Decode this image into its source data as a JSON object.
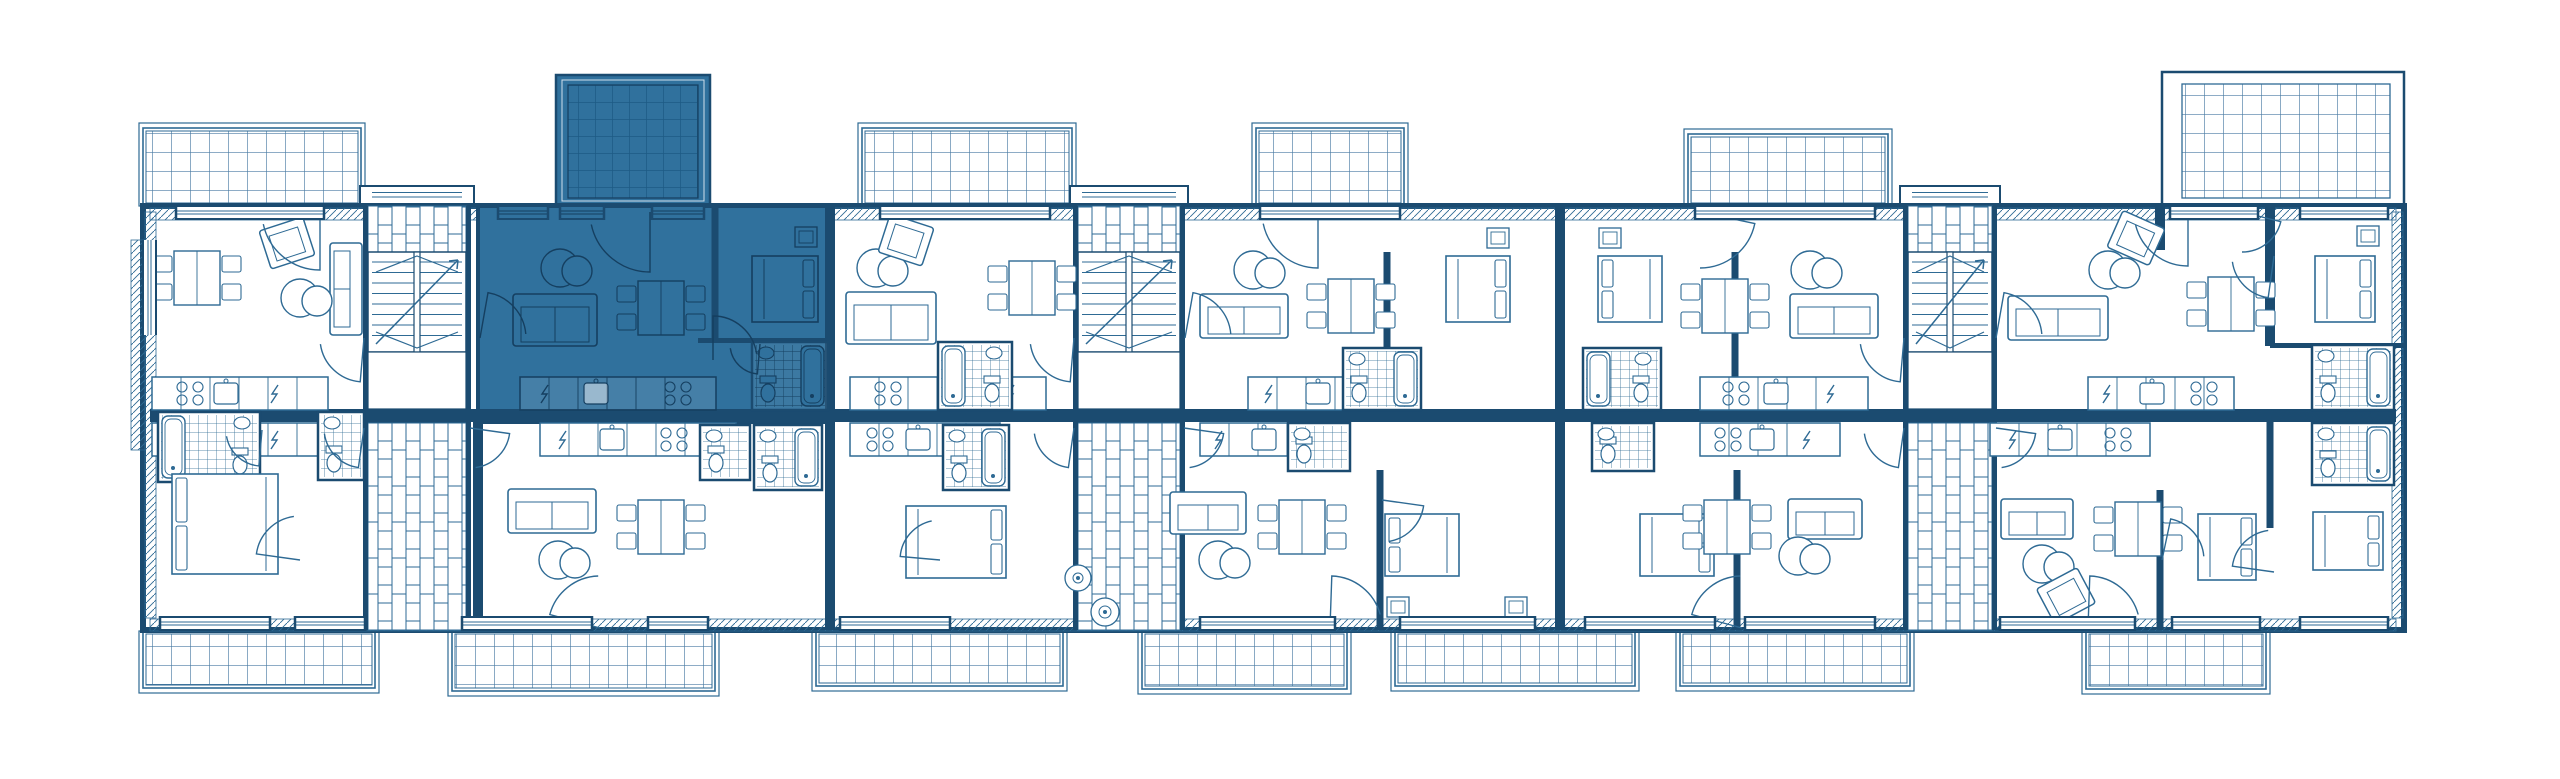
{
  "plan": {
    "canvas": {
      "w": 2560,
      "h": 779
    },
    "colors": {
      "line": "#2e6a94",
      "dark": "#1b4b70",
      "grid": "#4a7ba3",
      "light": "#9db9ce",
      "highlight": "#30719d",
      "highlight_line": "#153f60",
      "highlight_grid": "#1d5a85",
      "background": "#ffffff"
    },
    "building": {
      "x": 143,
      "y": 206,
      "w": 2261,
      "h": 424
    },
    "spine": {
      "x": 150,
      "y": 409,
      "w": 2246,
      "h": 13
    },
    "hatch_bands": [
      [
        150,
        208,
        2246,
        12
      ],
      [
        150,
        619,
        2246,
        12
      ],
      [
        145,
        212,
        11,
        406
      ],
      [
        2392,
        212,
        11,
        406
      ],
      [
        131,
        240,
        14,
        210
      ]
    ],
    "highlight_unit": {
      "x": 478,
      "y": 206,
      "w": 352,
      "h": 216
    },
    "terrace_highlight": [
      556,
      75,
      154,
      131
    ],
    "terrace_right": [
      2162,
      72,
      242,
      134
    ],
    "balconies_top": [
      [
        143,
        128,
        218,
        78
      ],
      [
        862,
        128,
        210,
        78
      ],
      [
        1256,
        128,
        148,
        78
      ],
      [
        1688,
        134,
        200,
        72
      ]
    ],
    "balconies_bottom": [
      [
        143,
        631,
        232,
        57
      ],
      [
        452,
        631,
        263,
        60
      ],
      [
        816,
        631,
        247,
        55
      ],
      [
        1142,
        631,
        205,
        58
      ],
      [
        1395,
        631,
        240,
        55
      ],
      [
        1680,
        631,
        230,
        55
      ],
      [
        2086,
        631,
        180,
        58
      ]
    ],
    "cores": [
      [
        368,
        98
      ],
      [
        1078,
        102
      ],
      [
        1908,
        84
      ]
    ],
    "core_bands": {
      "brick_top_h": 46,
      "stairs_h": 100,
      "landing_h": 57
    },
    "dividers": [
      [
        830,
        206,
        204,
        10
      ],
      [
        1560,
        206,
        204,
        10
      ],
      [
        2270,
        206,
        140,
        10
      ],
      [
        715,
        206,
        136,
        7
      ],
      [
        1387,
        252,
        158,
        7
      ],
      [
        1735,
        252,
        158,
        7
      ],
      [
        2160,
        206,
        44,
        10
      ],
      [
        478,
        422,
        208,
        10
      ],
      [
        830,
        422,
        208,
        10
      ],
      [
        1560,
        422,
        208,
        10
      ],
      [
        1380,
        470,
        160,
        7
      ],
      [
        1737,
        470,
        160,
        7
      ],
      [
        2270,
        422,
        106,
        7
      ],
      [
        2160,
        490,
        140,
        7
      ]
    ],
    "hwalls": [
      [
        698,
        338,
        132
      ],
      [
        2270,
        343,
        134
      ]
    ],
    "windows_top": [
      [
        176,
        148
      ],
      [
        498,
        50
      ],
      [
        560,
        44
      ],
      [
        652,
        52
      ],
      [
        880,
        170
      ],
      [
        1260,
        140
      ],
      [
        1695,
        180
      ],
      [
        2170,
        88
      ],
      [
        2300,
        88
      ]
    ],
    "windows_bottom": [
      [
        160,
        110
      ],
      [
        295,
        70
      ],
      [
        462,
        130
      ],
      [
        648,
        60
      ],
      [
        840,
        110
      ],
      [
        1200,
        135
      ],
      [
        1400,
        135
      ],
      [
        1585,
        130
      ],
      [
        1745,
        130
      ],
      [
        2000,
        135
      ],
      [
        2172,
        88
      ],
      [
        2300,
        88
      ]
    ],
    "windows_left": [
      [
        240,
        95
      ]
    ],
    "kitchens": [
      [
        152,
        377,
        176,
        112,
        62,
        22
      ],
      [
        520,
        377,
        196,
        14,
        64,
        142
      ],
      [
        850,
        377,
        196,
        150,
        96,
        22
      ],
      [
        1248,
        377,
        170,
        10,
        58,
        112
      ],
      [
        1700,
        377,
        168,
        120,
        64,
        20
      ],
      [
        2088,
        377,
        146,
        8,
        52,
        100
      ],
      [
        152,
        423,
        176,
        112,
        62,
        22
      ],
      [
        540,
        423,
        196,
        12,
        60,
        118
      ],
      [
        850,
        423,
        150,
        104,
        56,
        14
      ],
      [
        1200,
        423,
        148,
        8,
        52,
        100
      ],
      [
        1700,
        423,
        140,
        96,
        50,
        12
      ],
      [
        1990,
        423,
        160,
        12,
        58,
        112
      ]
    ],
    "bathrooms": [
      [
        752,
        342,
        76,
        68,
        2
      ],
      [
        938,
        342,
        74,
        68,
        1
      ],
      [
        1343,
        348,
        78,
        62,
        2
      ],
      [
        1583,
        348,
        78,
        62,
        1
      ],
      [
        2312,
        345,
        82,
        65,
        2
      ],
      [
        158,
        412,
        102,
        70,
        1
      ],
      [
        318,
        412,
        46,
        68,
        0
      ],
      [
        700,
        425,
        50,
        55,
        0
      ],
      [
        754,
        425,
        68,
        65,
        2
      ],
      [
        943,
        425,
        66,
        65,
        2
      ],
      [
        1288,
        423,
        62,
        48,
        0
      ],
      [
        1592,
        423,
        62,
        48,
        0
      ],
      [
        2312,
        423,
        82,
        62,
        2
      ]
    ],
    "beds": [
      [
        752,
        256,
        66,
        66,
        "r"
      ],
      [
        1446,
        256,
        64,
        66,
        "r"
      ],
      [
        1598,
        256,
        64,
        66,
        "l"
      ],
      [
        2315,
        256,
        60,
        66,
        "r"
      ],
      [
        172,
        474,
        106,
        100,
        "l"
      ],
      [
        906,
        506,
        100,
        72,
        "r"
      ],
      [
        1385,
        514,
        74,
        62,
        "l"
      ],
      [
        1640,
        514,
        74,
        62,
        "r"
      ],
      [
        2198,
        514,
        58,
        66,
        "r"
      ],
      [
        2313,
        512,
        70,
        58,
        "r"
      ]
    ],
    "sofas": [
      [
        330,
        243,
        32,
        92,
        "r"
      ],
      [
        513,
        294,
        84,
        52,
        "t"
      ],
      [
        846,
        292,
        90,
        52,
        "t"
      ],
      [
        1200,
        294,
        88,
        44,
        "t"
      ],
      [
        1790,
        294,
        88,
        44,
        "t"
      ],
      [
        2008,
        296,
        100,
        44,
        "t"
      ],
      [
        508,
        489,
        88,
        44,
        "t"
      ],
      [
        1170,
        492,
        76,
        42,
        "t"
      ],
      [
        1788,
        499,
        74,
        40,
        "t"
      ],
      [
        2001,
        499,
        72,
        40,
        "t"
      ]
    ],
    "poufs": [
      [
        300,
        298
      ],
      [
        560,
        268
      ],
      [
        876,
        268
      ],
      [
        1253,
        270
      ],
      [
        1810,
        270
      ],
      [
        2108,
        270
      ],
      [
        558,
        560
      ],
      [
        1218,
        560
      ],
      [
        1798,
        556
      ],
      [
        2042,
        564
      ]
    ],
    "armchairs": [
      [
        287,
        243,
        -18
      ],
      [
        906,
        240,
        18
      ],
      [
        2136,
        238,
        24
      ],
      [
        2066,
        596,
        -28
      ]
    ],
    "dinings": [
      [
        197,
        278
      ],
      [
        661,
        308
      ],
      [
        1032,
        288
      ],
      [
        1351,
        306
      ],
      [
        1725,
        306
      ],
      [
        2231,
        304
      ],
      [
        661,
        527
      ],
      [
        1302,
        527
      ],
      [
        1727,
        527
      ],
      [
        2138,
        529
      ]
    ],
    "side_tables": [
      [
        806,
        237
      ],
      [
        1498,
        238
      ],
      [
        1610,
        238
      ],
      [
        2368,
        236
      ],
      [
        1398,
        607
      ],
      [
        1516,
        607
      ]
    ],
    "washers": [
      [
        1078,
        578,
        13
      ],
      [
        1105,
        612,
        14
      ]
    ],
    "doors": [
      [
        650,
        212,
        60,
        90,
        168
      ],
      [
        480,
        338,
        46,
        280,
        355
      ],
      [
        713,
        360,
        44,
        270,
        352
      ],
      [
        760,
        344,
        30,
        95,
        172
      ],
      [
        320,
        212,
        58,
        90,
        168
      ],
      [
        364,
        338,
        44,
        95,
        172
      ],
      [
        1074,
        338,
        44,
        95,
        172
      ],
      [
        1185,
        338,
        46,
        280,
        355
      ],
      [
        1904,
        338,
        44,
        95,
        172
      ],
      [
        1996,
        338,
        46,
        280,
        355
      ],
      [
        1318,
        212,
        56,
        90,
        168
      ],
      [
        1700,
        212,
        56,
        12,
        90
      ],
      [
        2188,
        212,
        54,
        90,
        166
      ],
      [
        2242,
        212,
        40,
        14,
        90
      ],
      [
        2274,
        256,
        42,
        98,
        172
      ],
      [
        600,
        628,
        52,
        195,
        268
      ],
      [
        1330,
        628,
        52,
        272,
        345
      ],
      [
        1742,
        628,
        52,
        195,
        268
      ],
      [
        2088,
        628,
        52,
        272,
        345
      ],
      [
        364,
        428,
        40,
        98,
        172
      ],
      [
        470,
        428,
        40,
        8,
        82
      ],
      [
        1074,
        428,
        40,
        98,
        172
      ],
      [
        1184,
        428,
        40,
        8,
        82
      ],
      [
        1904,
        428,
        40,
        98,
        172
      ],
      [
        1996,
        428,
        40,
        8,
        82
      ],
      [
        300,
        560,
        44,
        188,
        262
      ],
      [
        262,
        430,
        36,
        95,
        170
      ],
      [
        1382,
        500,
        42,
        8,
        80
      ],
      [
        2162,
        560,
        42,
        282,
        355
      ],
      [
        2274,
        572,
        42,
        188,
        262
      ],
      [
        940,
        560,
        40,
        185,
        258
      ]
    ]
  }
}
